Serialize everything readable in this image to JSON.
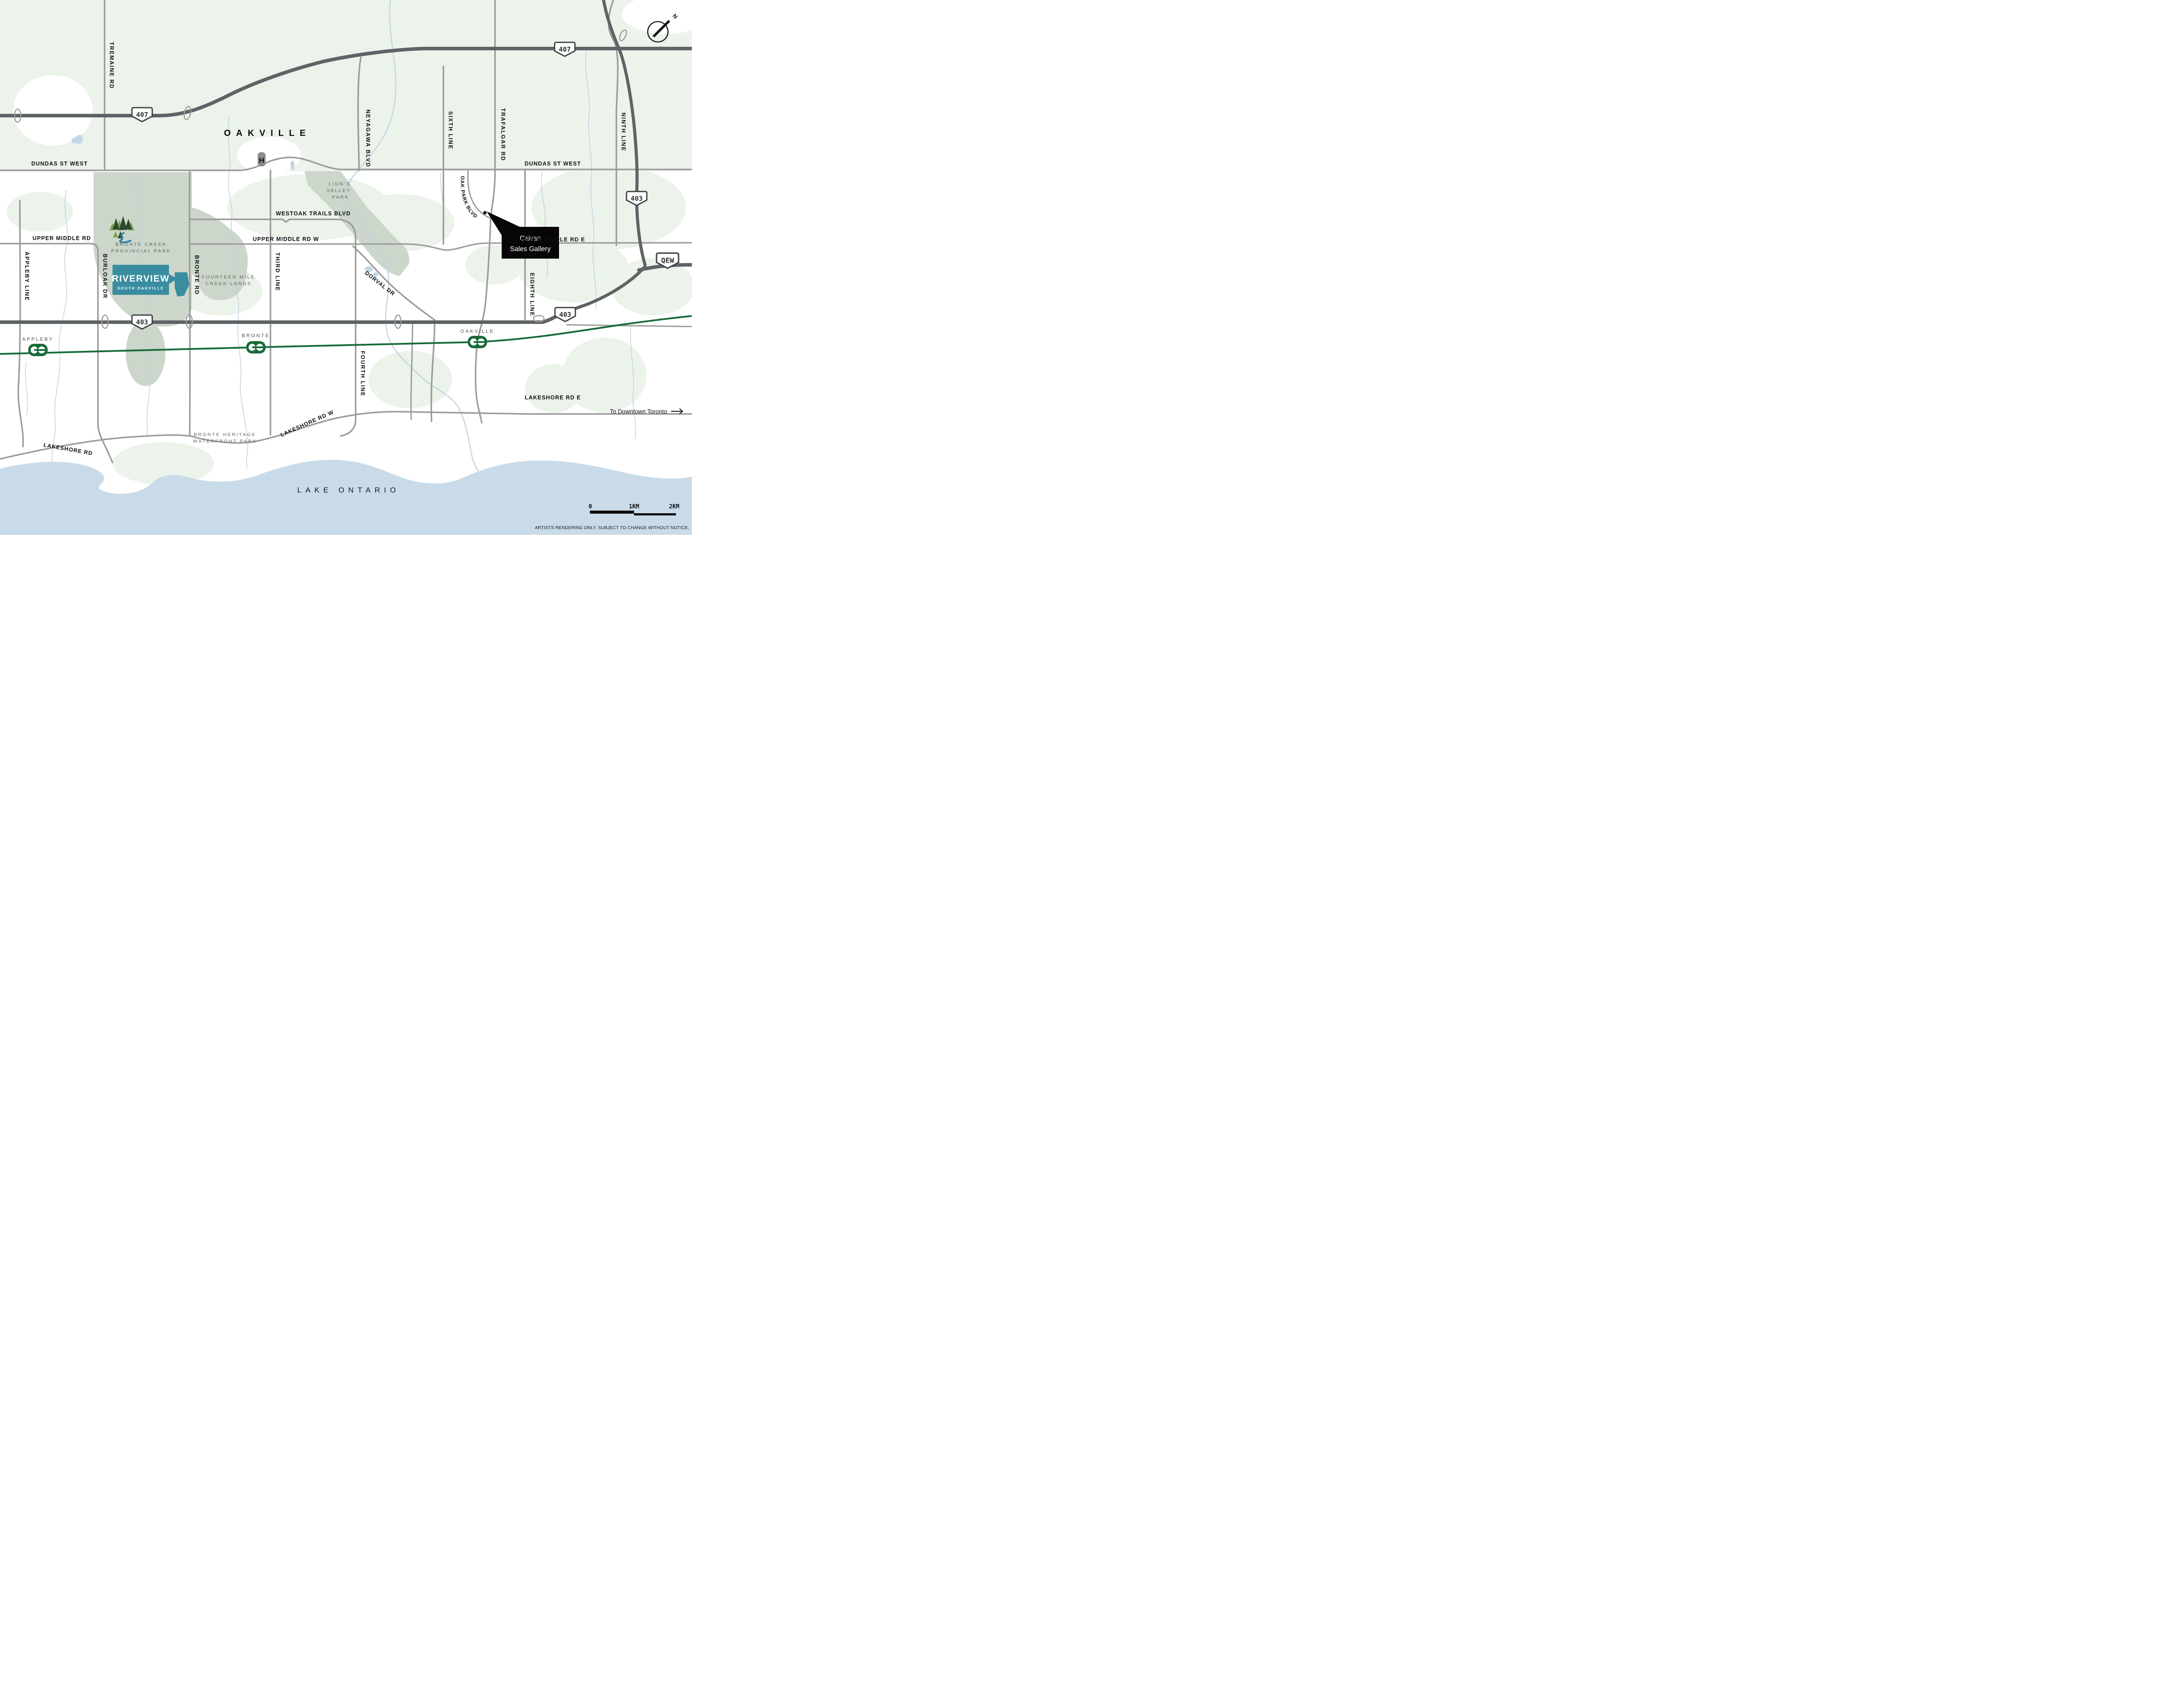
{
  "map": {
    "city_label": "OAKVILLE",
    "lake_label": "LAKE ONTARIO",
    "compass_n": "N",
    "hospital_h": "H",
    "to_toronto": "To Downtown Toronto",
    "disclaimer": "ARTISTS RENDERING ONLY. SUBJECT TO CHANGE WITHOUT NOTICE.",
    "scale": {
      "zero": "0",
      "one_km": "1KM",
      "two_km": "2KM"
    }
  },
  "logo": {
    "name": "RIVERVIEW",
    "sub": "SOUTH OAKVILLE"
  },
  "gallery": {
    "line1": "Caivan",
    "line2": "Sales Gallery"
  },
  "highways": {
    "h407_left": "407",
    "h407_right": "407",
    "h403_west": "403",
    "h403_mid": "403",
    "h403_north": "403",
    "qew": "QEW"
  },
  "roads": {
    "tremaine": "TREMAINE RD",
    "appleby_line": "APPLEBY LINE",
    "burloak": "BURLOAK DR",
    "bronte_rd": "BRONTE RD",
    "third_line": "THIRD LINE",
    "fourth_line": "FOURTH LINE",
    "neyagawa": "NEYAGAWA BLVD",
    "sixth_line": "SIXTH LINE",
    "trafalgar": "TRAFALGAR RD",
    "eighth_line": "EIGHTH LINE",
    "ninth_line": "NINTH LINE",
    "dundas_left": "DUNDAS ST WEST",
    "dundas_right": "DUNDAS ST WEST",
    "westoak": "WESTOAK TRAILS BLVD",
    "upper_middle": "UPPER MIDDLE RD",
    "upper_middle_w": "UPPER MIDDLE RD W",
    "upper_middle_e": "UPPER MIDDLE RD E",
    "dorval": "DORVAL DR",
    "oak_park": "OAK PARK BLVD",
    "lakeshore": "LAKESHORE RD",
    "lakeshore_w": "LAKESHORE RD W",
    "lakeshore_e": "LAKESHORE RD E"
  },
  "stations": {
    "appleby": "APPLEBY",
    "bronte": "BRONTE",
    "oakville": "OAKVILLE"
  },
  "parks": {
    "bronte_creek_1": "BRONTE CREEK",
    "bronte_creek_2": "PROVINCIAL PARK",
    "lions_1": "LION'S",
    "lions_2": "VALLEY",
    "lions_3": "PARK",
    "fourteen_1": "FOURTEEN MILE",
    "fourteen_2": "CREEK LANDS",
    "heritage_1": "BRONTE HERITAGE",
    "heritage_2": "WATERFRONT PARK"
  },
  "colors": {
    "riverview_teal": "#3A8DA0",
    "go_green": "#176B3A",
    "highway_dark": "#5E6366",
    "road_gray": "#9B9B9B",
    "park_green": "#CCD6CA",
    "pale_green": "#ECF3EA",
    "lake_blue": "#C9DBE8",
    "creek_blue": "#BED3E2",
    "label_gray": "#5E6662",
    "callout_black": "#060606"
  }
}
